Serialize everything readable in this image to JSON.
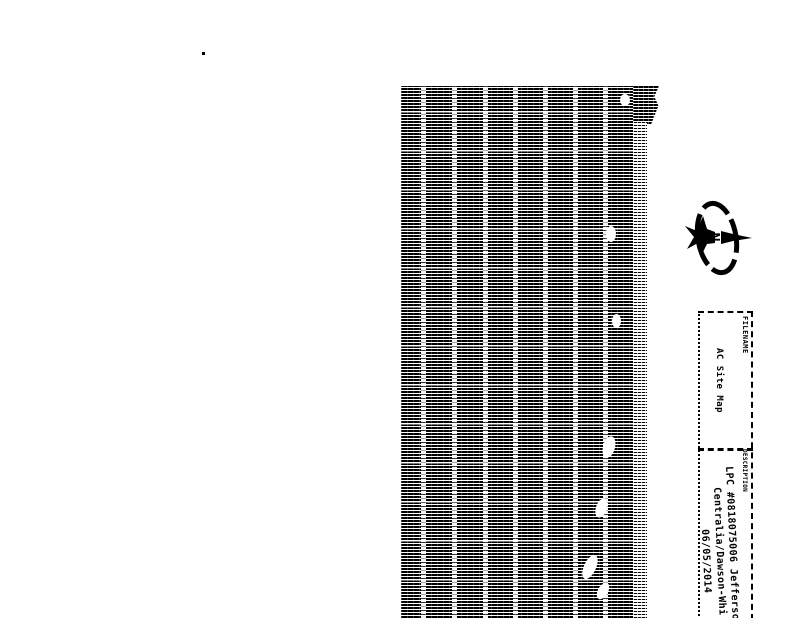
{
  "compass": {
    "north_label": "N"
  },
  "title_block": {
    "filename": {
      "label": "FILENAME",
      "value": "AC Site Map"
    },
    "description": {
      "label": "DESCRIPTION",
      "line1": "LPC #0818075006  Jefferson",
      "line2": "Centralia/Dawson-Whi",
      "line3": "06/05/2014"
    }
  },
  "colors": {
    "ink": "#000000",
    "paper": "#ffffff"
  }
}
